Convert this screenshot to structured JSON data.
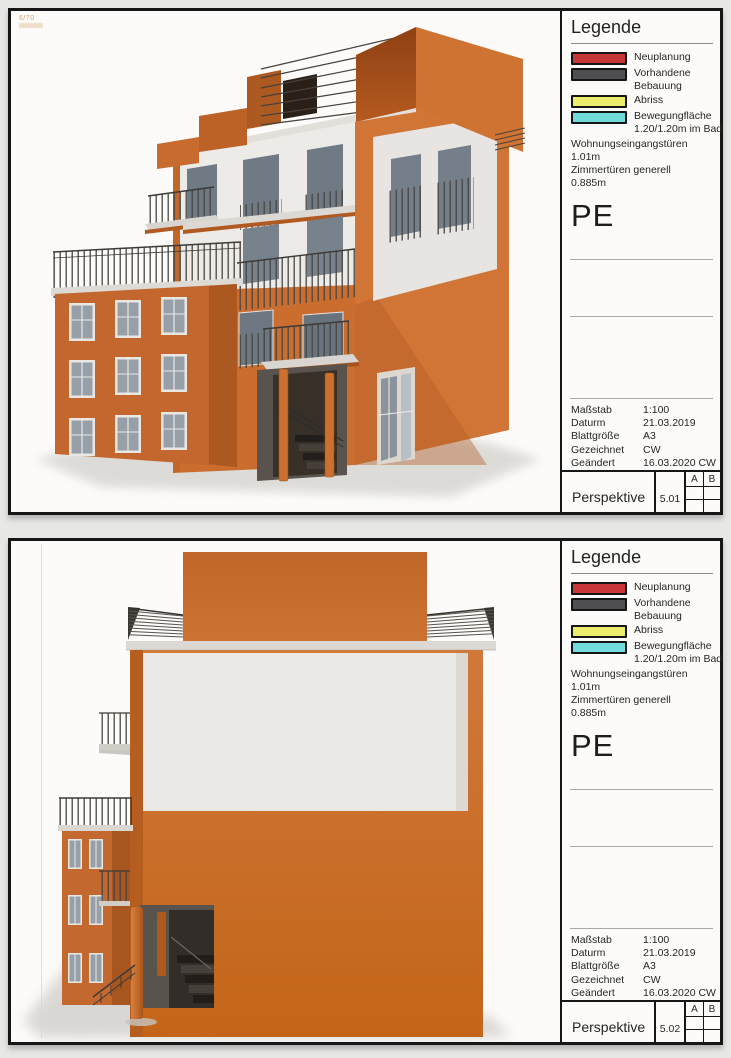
{
  "page": {
    "background": "#e7e7e5"
  },
  "colors": {
    "sheet_border": "#161616",
    "orange_facade": "#c96e2e",
    "orange_dark": "#a5561d",
    "white_facade": "#eceae7",
    "window_glass": "#76818c",
    "railing": "#46413b",
    "ground_shadow": "#d8d6d2"
  },
  "stamp": {
    "text": "6/70"
  },
  "sheets": [
    {
      "legend": {
        "title": "Legende",
        "items": [
          {
            "color": "#c8363a",
            "label": "Neuplanung",
            "label2": ""
          },
          {
            "color": "#4f4f51",
            "label": "Vorhandene",
            "label2": "Bebauung"
          },
          {
            "color": "#ecec6c",
            "label": "Abriss",
            "label2": ""
          },
          {
            "color": "#72dbdb",
            "label": "Bewegungfläche",
            "label2": "1.20/1.20m im Bad"
          }
        ],
        "notes": [
          "Wohnungseingangstüren",
          "1.01m",
          "Zimmertüren generell",
          "0.885m"
        ],
        "code": "PE"
      },
      "info": {
        "rows": [
          {
            "label": "Maßstab",
            "value": "1:100"
          },
          {
            "label": "Daturm",
            "value": "21.03.2019"
          },
          {
            "label": "Blattgröße",
            "value": "A3"
          },
          {
            "label": "Gezeichnet",
            "value": "CW"
          },
          {
            "label": "Geändert",
            "value": "16.03.2020 CW"
          }
        ]
      },
      "titlebar": {
        "title": "Perspektive",
        "number": "5.01",
        "grid_cols": [
          "A",
          "B"
        ]
      }
    },
    {
      "legend": {
        "title": "Legende",
        "items": [
          {
            "color": "#c8363a",
            "label": "Neuplanung",
            "label2": ""
          },
          {
            "color": "#4f4f51",
            "label": "Vorhandene",
            "label2": "Bebauung"
          },
          {
            "color": "#ecec6c",
            "label": "Abriss",
            "label2": ""
          },
          {
            "color": "#72dbdb",
            "label": "Bewegungfläche",
            "label2": "1.20/1.20m im Bad"
          }
        ],
        "notes": [
          "Wohnungseingangstüren",
          "1.01m",
          "Zimmertüren generell",
          "0.885m"
        ],
        "code": "PE"
      },
      "info": {
        "rows": [
          {
            "label": "Maßstab",
            "value": "1:100"
          },
          {
            "label": "Daturm",
            "value": "21.03.2019"
          },
          {
            "label": "Blattgröße",
            "value": "A3"
          },
          {
            "label": "Gezeichnet",
            "value": "CW"
          },
          {
            "label": "Geändert",
            "value": "16.03.2020 CW"
          }
        ]
      },
      "titlebar": {
        "title": "Perspektive",
        "number": "5.02",
        "grid_cols": [
          "A",
          "B"
        ]
      }
    }
  ]
}
